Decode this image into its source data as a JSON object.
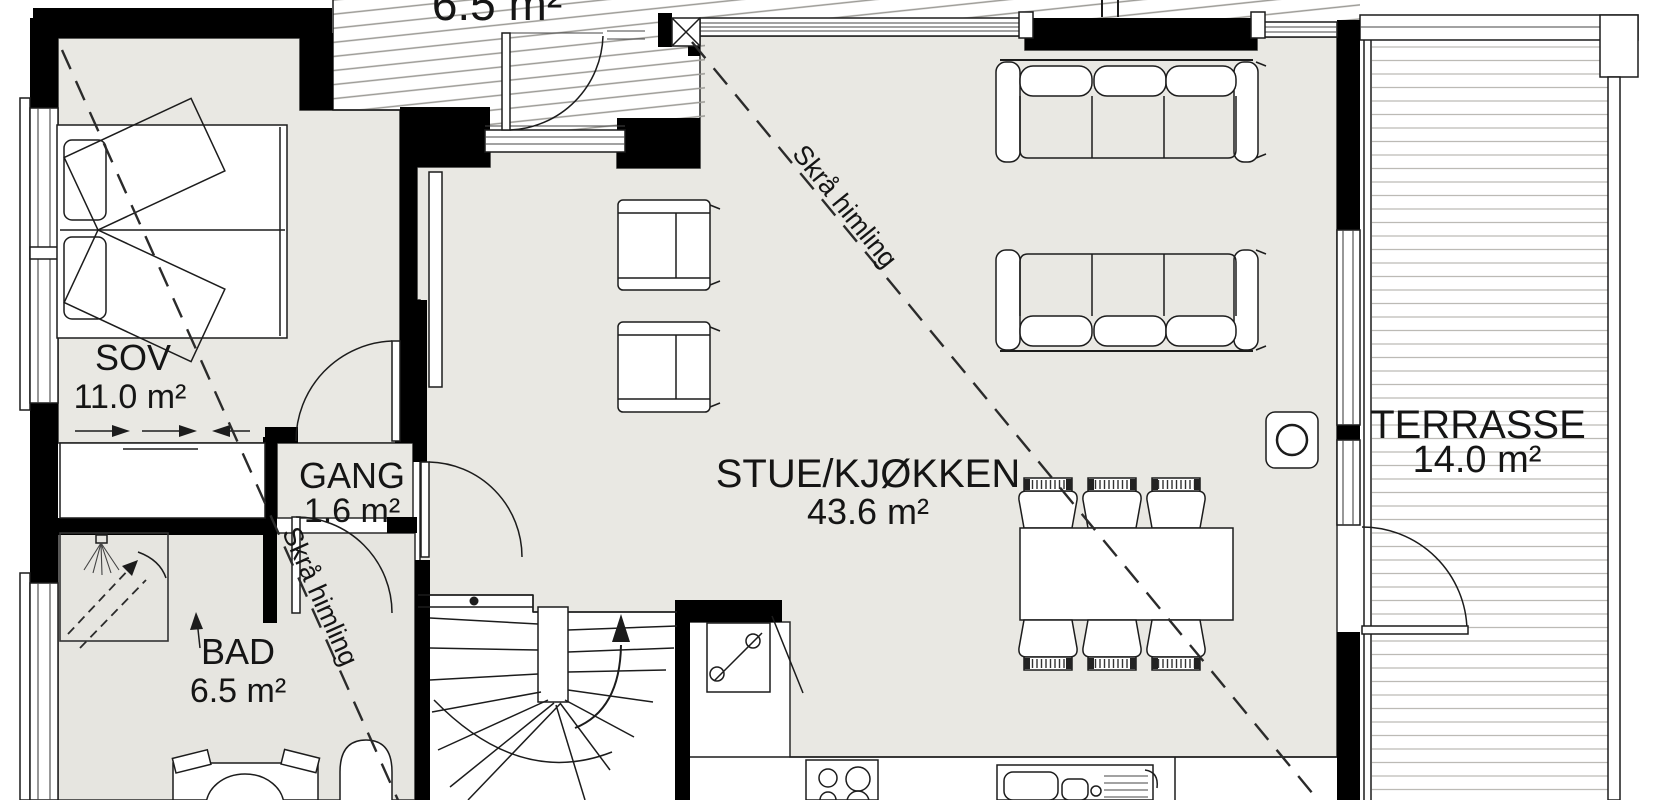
{
  "plan": {
    "title_partial_top": "6.5 m²",
    "rooms": [
      {
        "id": "sov",
        "label": "SOV",
        "area": "11.0 m²"
      },
      {
        "id": "gang",
        "label": "GANG",
        "area": "1.6 m²"
      },
      {
        "id": "bad",
        "label": "BAD",
        "area": "6.5 m²"
      },
      {
        "id": "stue_kjokken",
        "label": "STUE/KJØKKEN",
        "area": "43.6 m²"
      },
      {
        "id": "terrasse",
        "label": "TERRASSE",
        "area": "14.0 m²"
      }
    ],
    "annotations": [
      {
        "id": "skra1",
        "text": "Skrå himling"
      },
      {
        "id": "skra2",
        "text": "Skrå himling"
      }
    ],
    "stair_direction": "up",
    "furniture_icons": [
      "double-bed-icon",
      "wardrobe-sliding-icon",
      "shower-icon",
      "vanity-sink-icon",
      "toilet-icon",
      "winder-staircase-icon",
      "kitchen-appliance-icon",
      "cooktop-icon",
      "kitchen-sink-icon",
      "armchair-icon",
      "armchair-icon",
      "sofa-icon",
      "sofa-icon",
      "dining-table-icon",
      "dining-chair-icon",
      "wood-stove-icon",
      "entry-door-icon",
      "terrace-door-icon"
    ],
    "colors": {
      "wall": "#000000",
      "floor": "#e9e8e3",
      "bath_floor": "#e6e5e0",
      "line": "#1c1c1c",
      "deck_line": "#bcbab5",
      "hatch_line": "#9b9a95",
      "background": "#ffffff"
    }
  }
}
